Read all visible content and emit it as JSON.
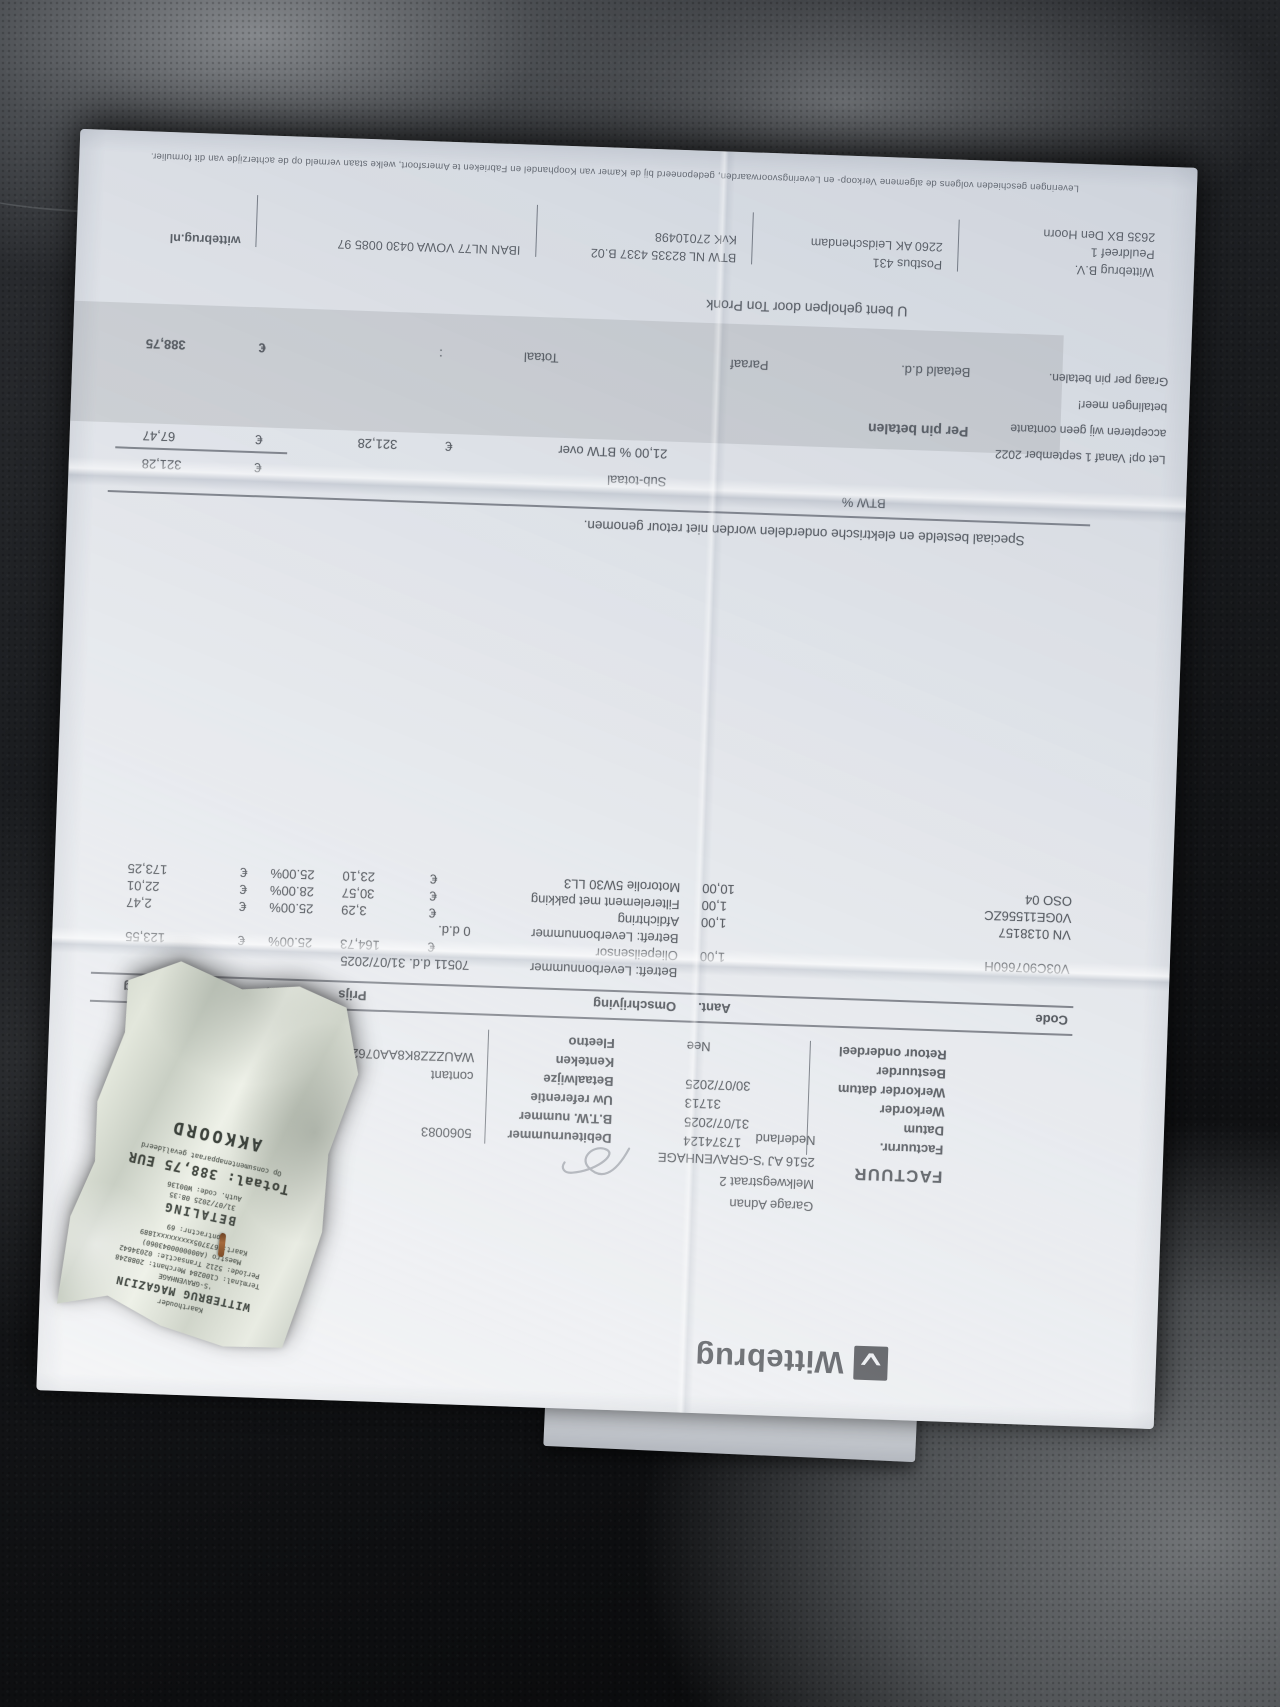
{
  "colors": {
    "paper": "#e9ebee",
    "ink": "#2e3237",
    "leather_dark": "#0e0f11",
    "leather_light": "#85888c",
    "receipt_paper": "#dde1d8",
    "band_gray": "#7e8380",
    "staple_rust": "#a56a3c"
  },
  "invoice": {
    "currency": "€",
    "logo_text": "Wittebrug",
    "title": "FACTUUR",
    "customer": {
      "line1": "Garage Adnan",
      "line2": "Melkwegstraat 2",
      "line3": "2516 AJ 'S-GRAVENHAGE",
      "line4": "Nederland"
    },
    "fields_left": [
      {
        "l": "Factuurnr.",
        "v": "17374124"
      },
      {
        "l": "Datum",
        "v": "31/07/2025"
      },
      {
        "l": "Werkorder",
        "v": "31713"
      },
      {
        "l": "Werkorder datum",
        "v": "30/07/2025"
      },
      {
        "l": "Bestuurder",
        "v": ""
      },
      {
        "l": "Retour onderdeel",
        "v": "Nee"
      }
    ],
    "fields_right": [
      {
        "l": "Debiteurnummer",
        "v": "5060083"
      },
      {
        "l": "B.T.W. nummer",
        "v": ""
      },
      {
        "l": "Uw referentie",
        "v": ""
      },
      {
        "l": "Betaalwijze",
        "v": "contant"
      },
      {
        "l": "Kenteken",
        "v": "WAUZZZ8K8AA076260"
      },
      {
        "l": "Fleetno",
        "v": ""
      }
    ],
    "table": {
      "headers": {
        "code": "Code",
        "qty": "Aant.",
        "desc": "Omschrijving",
        "price": "Prijs",
        "disc": "%Krt",
        "amount": "Bedrag"
      },
      "rows": [
        {
          "type": "ref",
          "code": "",
          "qty": "",
          "desc": "Betreft: Leverbonnummer",
          "ref": "70511 d.d. 31/07/2025",
          "price": "",
          "disc": "",
          "amount": ""
        },
        {
          "type": "item",
          "code": "V03C907660H",
          "qty": "1,00",
          "desc": "Oliepeilsensor",
          "ref": "",
          "price": "164,73",
          "disc": "25.00%",
          "amount": "123,55"
        },
        {
          "type": "ref",
          "code": "",
          "qty": "",
          "desc": "Betreft: Leverbonnummer",
          "ref": "0 d.d.",
          "price": "",
          "disc": "",
          "amount": ""
        },
        {
          "type": "item",
          "code": "VN 0138157",
          "qty": "1,00",
          "desc": "Afdichtring",
          "ref": "",
          "price": "3,29",
          "disc": "25.00%",
          "amount": "2,47"
        },
        {
          "type": "item",
          "code": "V0GE11556ZC",
          "qty": "1,00",
          "desc": "Filterelement met pakking",
          "ref": "",
          "price": "30,57",
          "disc": "28.00%",
          "amount": "22,01"
        },
        {
          "type": "item",
          "code": "OSO 04",
          "qty": "10,00",
          "desc": "Motorolie 5W30 LL3",
          "ref": "",
          "price": "23,10",
          "disc": "25.00%",
          "amount": "173,25"
        }
      ]
    },
    "note": "Speciaal bestelde en elektrische onderdelen worden niet retour genomen.",
    "btw_col": "BTW %",
    "subtotal_label": "Sub-totaal",
    "subtotal_value": "321,28",
    "btw_line": {
      "label": "21,00 % BTW over",
      "base": "321,28",
      "value": "67,47"
    },
    "pay": {
      "band_title": "Per pin betalen",
      "paid_label": "Betaald d.d.",
      "paraaf_label": "Paraaf",
      "total_label": "Totaal",
      "colon": ":",
      "total_value": "388,75"
    },
    "helped_by": "U bent geholpen door Ton Pronk",
    "warning": {
      "line1": "Let op! Vanaf 1 september 2022",
      "line2": "accepteren wij geen contante",
      "line3": "betalingen meer!",
      "line4": "Graag per pin betalen."
    },
    "footer": {
      "g1": {
        "line1": "Wittebrug B.V.",
        "line2": "Peuldreef 1",
        "line3": "2635 BX Den Hoorn"
      },
      "g2": {
        "line1": "Postbus 431",
        "line2": "2260 AK Leidschendam"
      },
      "g3": {
        "line1": "BTW NL 82335 4337 B.02",
        "line2": "KvK 27010498"
      },
      "g4": {
        "line1": "IBAN NL77 VOWA 0430 0085 97"
      },
      "g5": {
        "line1": "wittebrug.nl"
      }
    },
    "fine_print": "Leveringen geschieden volgens de algemene Verkoop- en Leveringsvoorwaarden, gedeponeerd bij de Kamer van Koophandel en Fabrieken te Amersfoort, welke staan vermeld op de achterzijde van dit formulier."
  },
  "receipt": {
    "holder": "Kaarthouder",
    "store": "WITTEBRUG MAGAZIJN",
    "city": "'S-GRAVENHAGE",
    "terminal": "Terminal: C100284  Merchant: 2088248",
    "period": "Periode: 5212  Transactie: 02034642",
    "scheme": "Maestro (A0000000043060)",
    "card": "Kaart: 673705xxxxxxxxx1889",
    "contract": "Contractnr: 69",
    "type": "BETALING",
    "datetime": "31/07/2025 08:35",
    "auth": "Auth. code: W00136",
    "total": "Totaal:  388,75 EUR",
    "validated": "Op consumentenapparaat gevalideerd",
    "result": "AKKOORD"
  }
}
